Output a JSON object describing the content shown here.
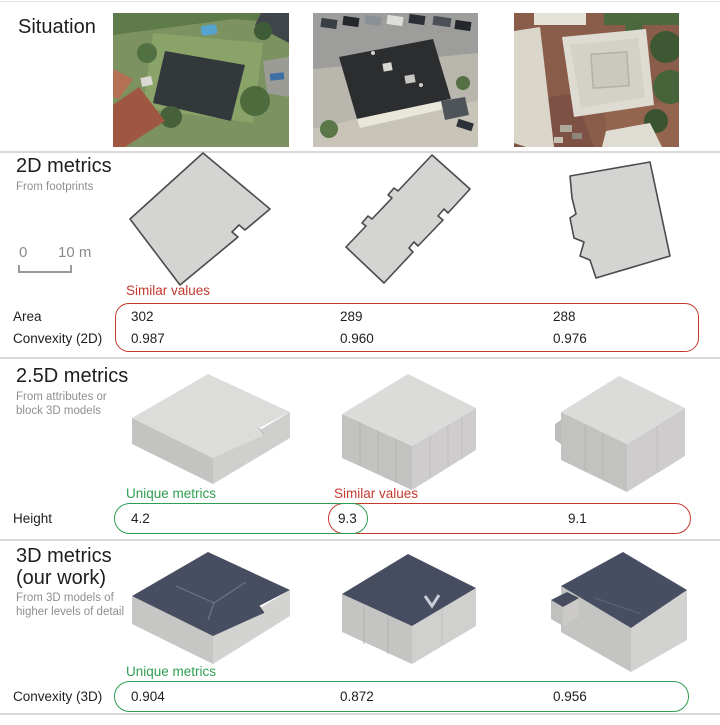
{
  "palette": {
    "red": "#c23a2e",
    "green": "#2f9e52",
    "divider": "#dadada",
    "title_color": "#1d1d1d",
    "muted": "#8f8f8f"
  },
  "situation": {
    "title": "Situation",
    "photos": [
      "aerial-photo-detached-house",
      "aerial-photo-office-building",
      "aerial-photo-flat-roof-complex"
    ]
  },
  "metrics_2d": {
    "title": "2D metrics",
    "subtitle": "From footprints",
    "scalebar": {
      "start_label": "0",
      "end_label": "10 m"
    },
    "annotation_similar": "Similar values",
    "rows": [
      {
        "label": "Area",
        "values": [
          "302",
          "289",
          "288"
        ]
      },
      {
        "label": "Convexity (2D)",
        "values": [
          "0.987",
          "0.960",
          "0.976"
        ]
      }
    ]
  },
  "metrics_25d": {
    "title": "2.5D metrics",
    "subtitle_line1": "From attributes or",
    "subtitle_line2": "block 3D models",
    "annotation_unique": "Unique metrics",
    "annotation_similar": "Similar values",
    "row": {
      "label": "Height",
      "values": [
        "4.2",
        "9.3",
        "9.1"
      ]
    }
  },
  "metrics_3d": {
    "title_line1": "3D metrics",
    "title_line2": "(our work)",
    "subtitle_line1": "From 3D models of",
    "subtitle_line2": "higher levels of detail",
    "annotation_unique": "Unique metrics",
    "row": {
      "label": "Convexity (3D)",
      "values": [
        "0.904",
        "0.872",
        "0.956"
      ]
    }
  }
}
